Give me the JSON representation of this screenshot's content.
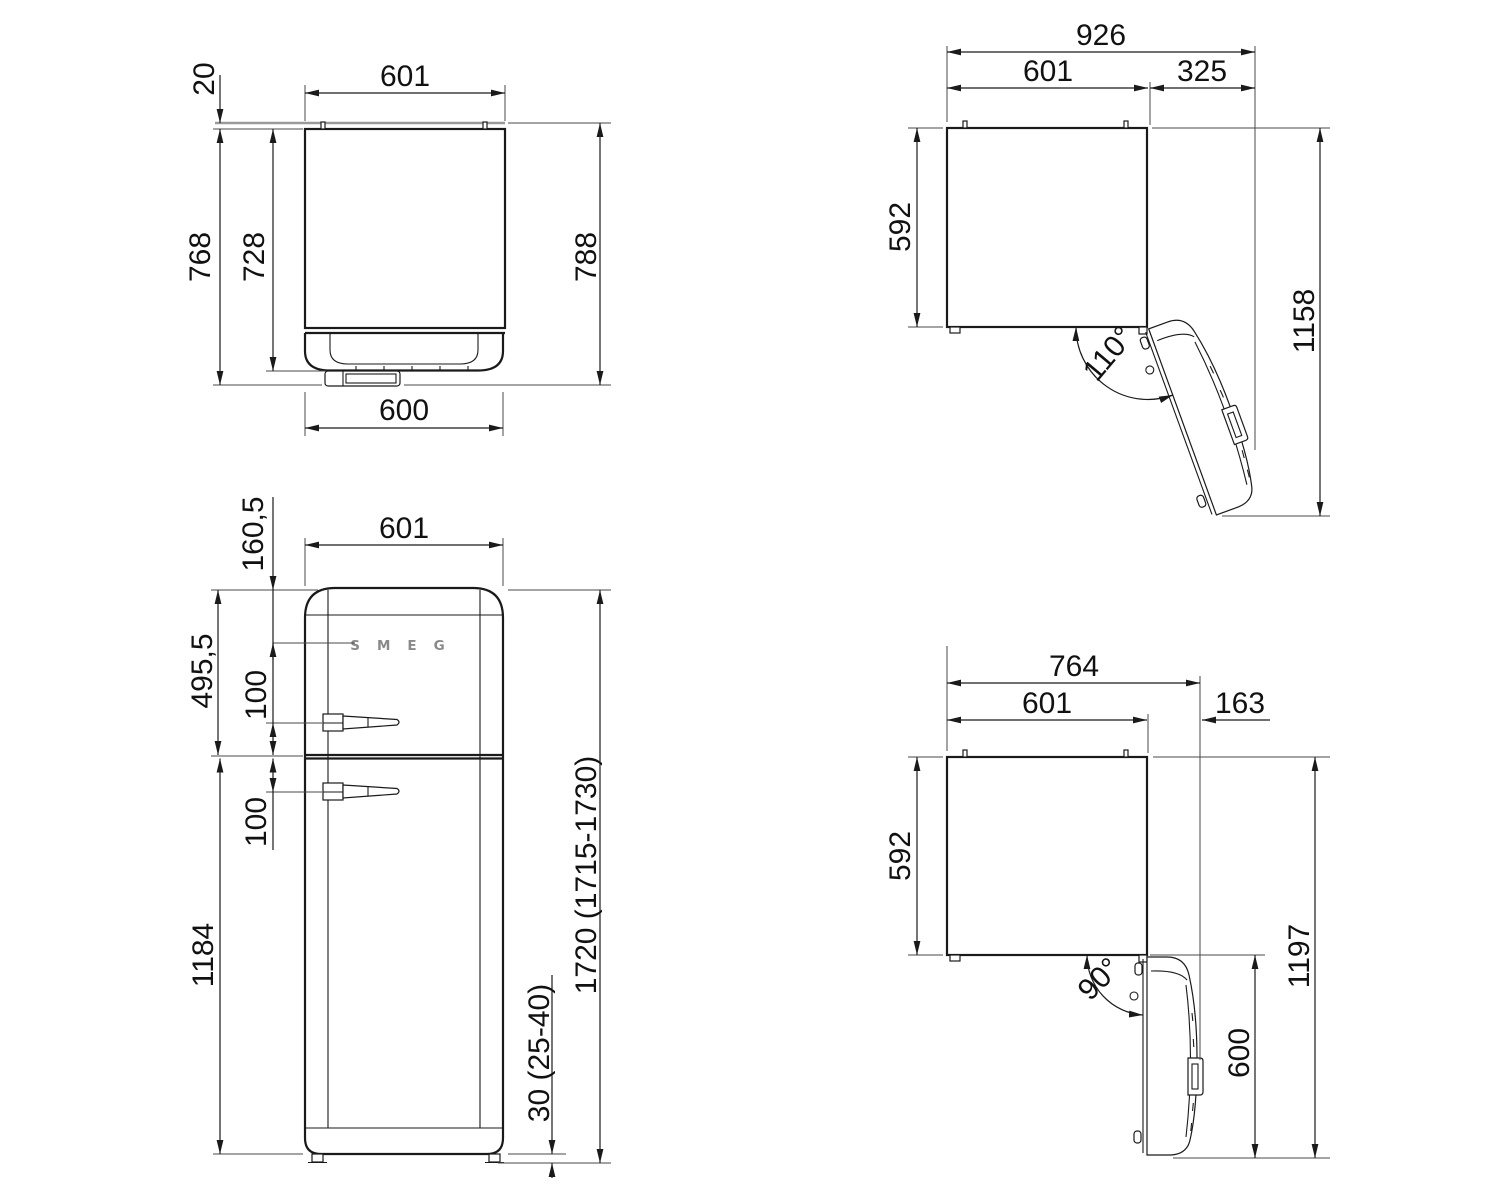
{
  "drawing": {
    "brand_logo": "SMEG",
    "views": {
      "side": {
        "dims": {
          "top_width": "601",
          "wall_gap": "20",
          "back_to_handle": "768",
          "back_to_door": "728",
          "wall_to_handle": "788",
          "bottom_width": "600"
        }
      },
      "open110": {
        "dims": {
          "total_width": "926",
          "cabinet_width": "601",
          "side_extension": "325",
          "cabinet_depth": "592",
          "total_depth": "1158",
          "angle": "110°"
        }
      },
      "front": {
        "dims": {
          "width": "601",
          "top_to_logo": "160,5",
          "top_to_divider": "495,5",
          "handle_to_divider": "100",
          "divider_to_handle": "100",
          "divider_to_bottom": "1184",
          "total_height": "1720 (1715-1730)",
          "base_clearance": "30 (25-40)"
        }
      },
      "open90": {
        "dims": {
          "total_width": "764",
          "cabinet_width": "601",
          "side_extension": "163",
          "cabinet_depth": "592",
          "total_depth": "1197",
          "door_depth": "600",
          "angle": "90°"
        }
      }
    },
    "colors": {
      "line": "#1a1a1a",
      "wall_line": "#9a9a9a",
      "logo": "#8a8a8a"
    }
  }
}
